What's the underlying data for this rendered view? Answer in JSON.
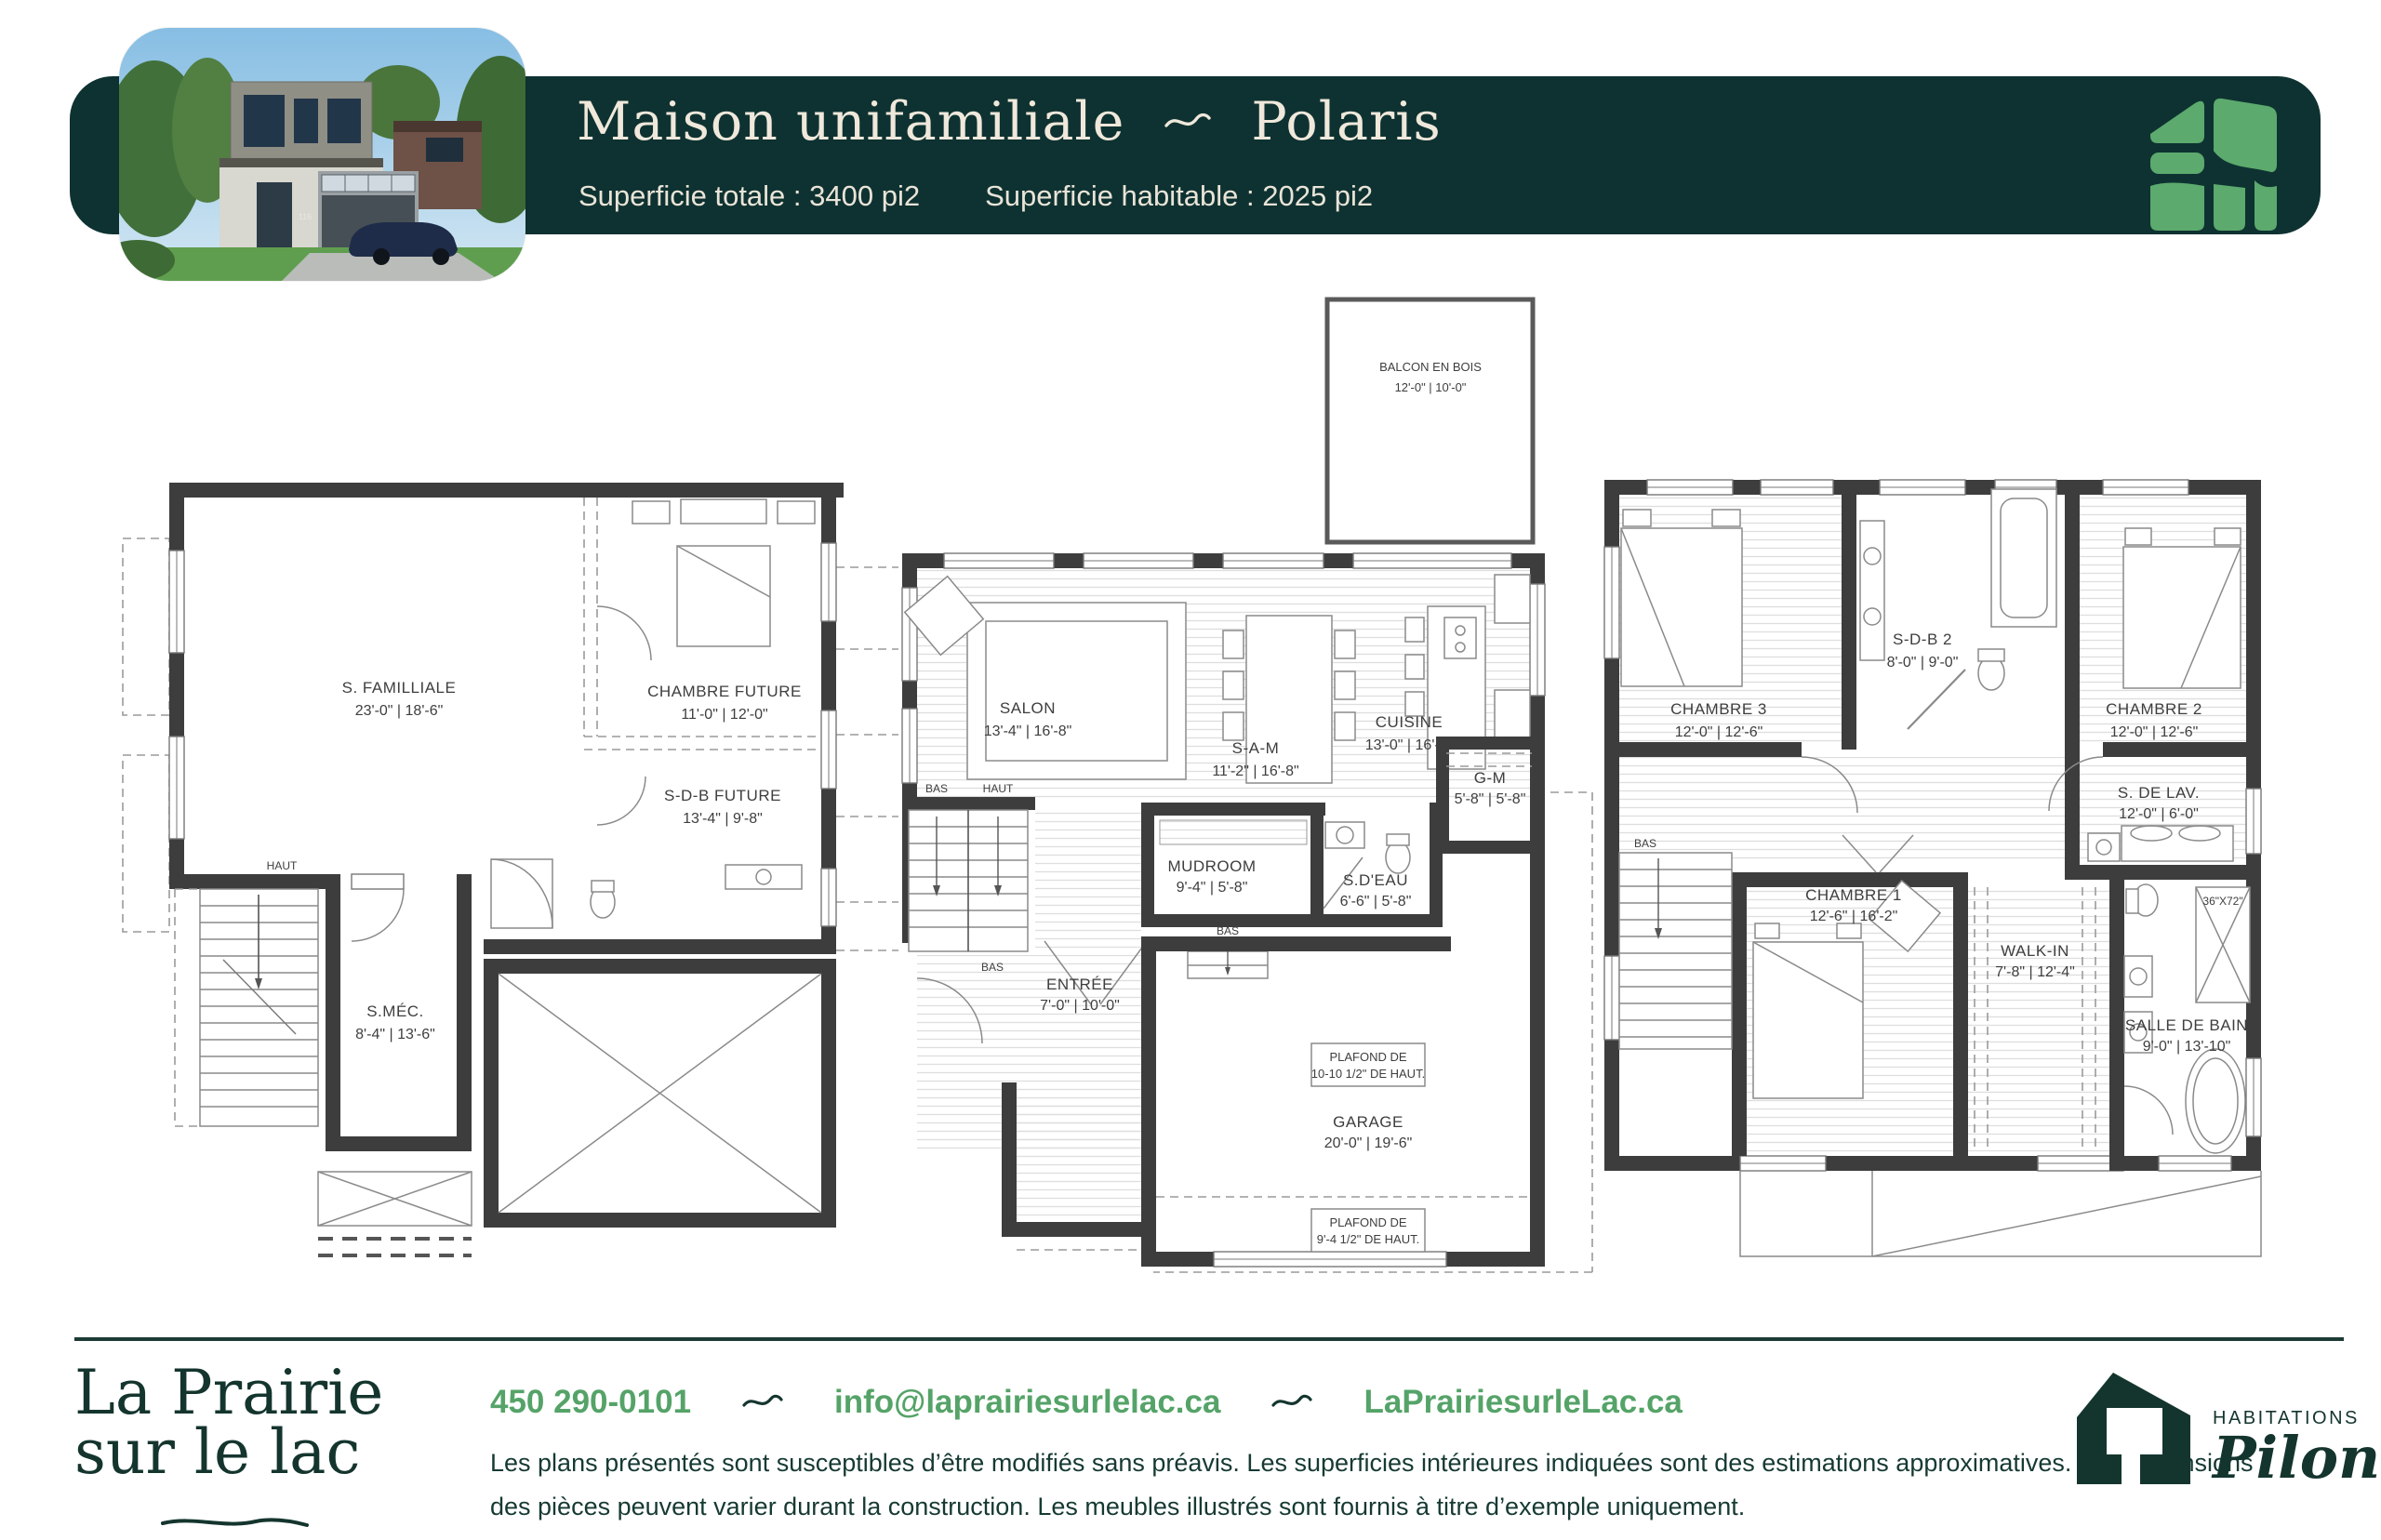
{
  "colors": {
    "banner": "#0E3231",
    "cream": "#EFE8DB",
    "logo_green": "#5CAA6E",
    "link_green": "#55A368",
    "footer_dark": "#14352E",
    "wall": "#3d3d3d"
  },
  "header": {
    "title_left": "Maison unifamiliale",
    "title_right": "Polaris",
    "subtitle_total": "Superficie totale : 3400 pi2",
    "subtitle_habitable": "Superficie habitable : 2025 pi2",
    "photo": {
      "house_number": "116"
    }
  },
  "plans": {
    "basement": {
      "rooms": {
        "familiale": {
          "label": "S. FAMILLIALE",
          "dims": "23'-0\" | 18'-6\""
        },
        "chambre_future": {
          "label": "CHAMBRE FUTURE",
          "dims": "11'-0\" | 12'-0\""
        },
        "sdb_future": {
          "label": "S-D-B FUTURE",
          "dims": "13'-4\" | 9'-8\""
        },
        "smec": {
          "label": "S.MÉC.",
          "dims": "8'-4\" | 13'-6\""
        }
      },
      "stairs": {
        "haut": "HAUT"
      }
    },
    "main": {
      "rooms": {
        "balcon": {
          "label": "BALCON EN BOIS",
          "dims": "12'-0\" | 10'-0\""
        },
        "salon": {
          "label": "SALON",
          "dims": "13'-4\" | 16'-8\""
        },
        "sam": {
          "label": "S-A-M",
          "dims": "11'-2\" | 16'-8\""
        },
        "cuisine": {
          "label": "CUISINE",
          "dims": "13'-0\" | 16'-8\""
        },
        "gm": {
          "label": "G-M",
          "dims": "5'-8\" | 5'-8\""
        },
        "mudroom": {
          "label": "MUDROOM",
          "dims": "9'-4\" | 5'-8\""
        },
        "sdeau": {
          "label": "S.D'EAU",
          "dims": "6'-6\" | 5'-8\""
        },
        "entree": {
          "label": "ENTRÉE",
          "dims": "7'-0\" | 10'-0\""
        },
        "garage": {
          "label": "GARAGE",
          "dims": "20'-0\" | 19'-6\""
        }
      },
      "notes": {
        "plafond1_l1": "PLAFOND DE",
        "plafond1_l2": "10-10 1/2\" DE HAUT.",
        "plafond2_l1": "PLAFOND DE",
        "plafond2_l2": "9'-4 1/2\" DE HAUT."
      },
      "stairs": {
        "bas": "BAS",
        "haut": "HAUT",
        "bas2": "BAS",
        "bas3": "BAS"
      }
    },
    "upper": {
      "rooms": {
        "chambre3": {
          "label": "CHAMBRE 3",
          "dims": "12'-0\" | 12'-6\""
        },
        "sdb2": {
          "label": "S-D-B 2",
          "dims": "8'-0\" | 9'-0\""
        },
        "chambre2": {
          "label": "CHAMBRE 2",
          "dims": "12'-0\" | 12'-6\""
        },
        "sdelav": {
          "label": "S. DE LAV.",
          "dims": "12'-0\" | 6'-0\""
        },
        "chambre1": {
          "label": "CHAMBRE 1",
          "dims": "12'-6\" | 16'-2\""
        },
        "walkin": {
          "label": "WALK-IN",
          "dims": "7'-8\" | 12'-4\""
        },
        "sdb": {
          "label": "SALLE DE BAIN",
          "dims": "9'-0\" | 13'-10\""
        }
      },
      "notes": {
        "shower": "36\"X72\""
      },
      "stairs": {
        "bas": "BAS"
      }
    }
  },
  "footer": {
    "brand_line1": "La Prairie",
    "brand_line2": "sur le lac",
    "phone": "450 290-0101",
    "email": "info@laprairiesurlelac.ca",
    "website": "LaPrairiesurleLac.ca",
    "disclaimer_line1": "Les plans présentés sont susceptibles d’être modifiés sans préavis. Les superficies intérieures indiquées sont des estimations approximatives. Les dimensions",
    "disclaimer_line2": "des pièces peuvent varier durant la construction. Les meubles illustrés sont fournis à titre d’exemple uniquement.",
    "pilon_top": "HABITATIONS",
    "pilon_name": "Pilon"
  }
}
